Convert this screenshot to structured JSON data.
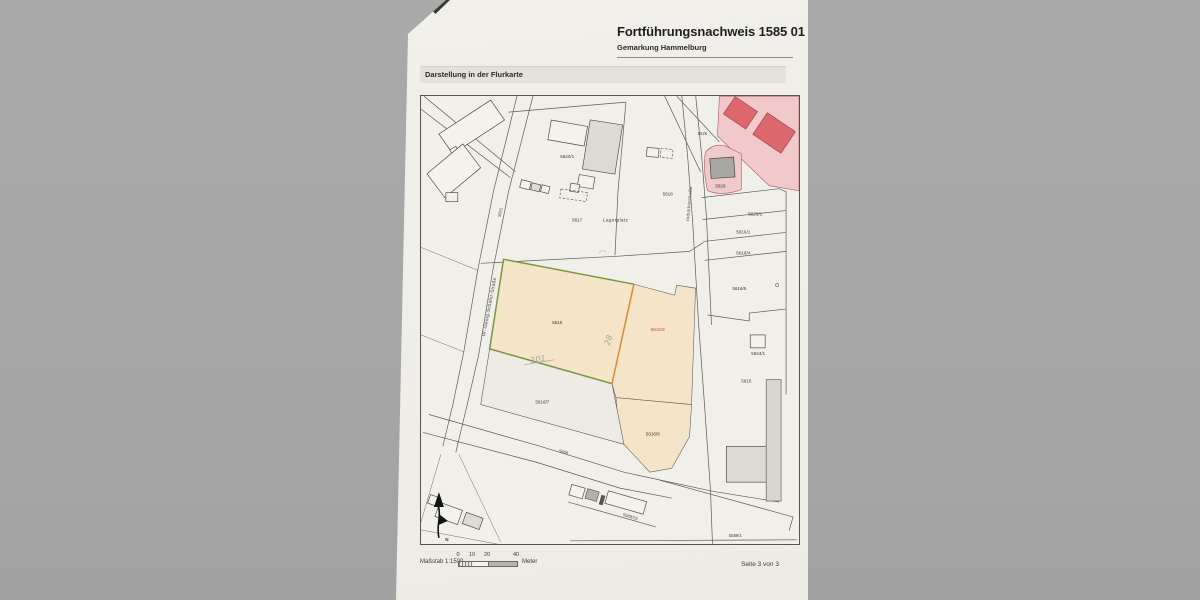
{
  "document": {
    "title": "Fortführungsnachweis 1585 01",
    "subtitle": "Gemarkung Hammelburg",
    "section_label": "Darstellung in der Flurkarte",
    "page_indicator": "Seite 3 von 3",
    "scale": {
      "label": "Maßstab 1:1500",
      "ticks": [
        "0",
        "10",
        "20",
        "40"
      ],
      "unit": "Meter"
    }
  },
  "map": {
    "streets": {
      "left_street": "Dr.-Georg-Schäfer-Straße",
      "right_street": "Industriestraße"
    },
    "areas": {
      "lagerplatz": "Lagerplatz"
    },
    "parcels": {
      "p5620_1": "5620/1",
      "p5617": "5617",
      "p5618": "5618",
      "p5621": "5621",
      "p5625": "5625",
      "p5626": "5626",
      "p5626_1": "5626/1",
      "p5616_1": "5616/1",
      "p5616_4": "5616/4",
      "p5616_5": "5616/5",
      "p5616": "5616",
      "p5616_9": "5616/9",
      "p5624_1": "5624/1",
      "p5615": "5615",
      "p5616_7": "5616/7",
      "p5616_8": "5616/8",
      "p5666": "5666",
      "p5589_23": "5589/23",
      "p5589_1": "5589/1"
    },
    "annotations": {
      "hw_101": "101",
      "hw_28": "28",
      "north": "N"
    },
    "colors": {
      "parcel_highlight_fill": "#f5e4c8",
      "green_boundary": "#76973c",
      "orange_boundary": "#dd8a2f",
      "red_label": "#c24b48",
      "pink_fill": "#f2c9cb",
      "red_building": "#dc686d",
      "dark_label_5626": "#8c4a47"
    }
  }
}
